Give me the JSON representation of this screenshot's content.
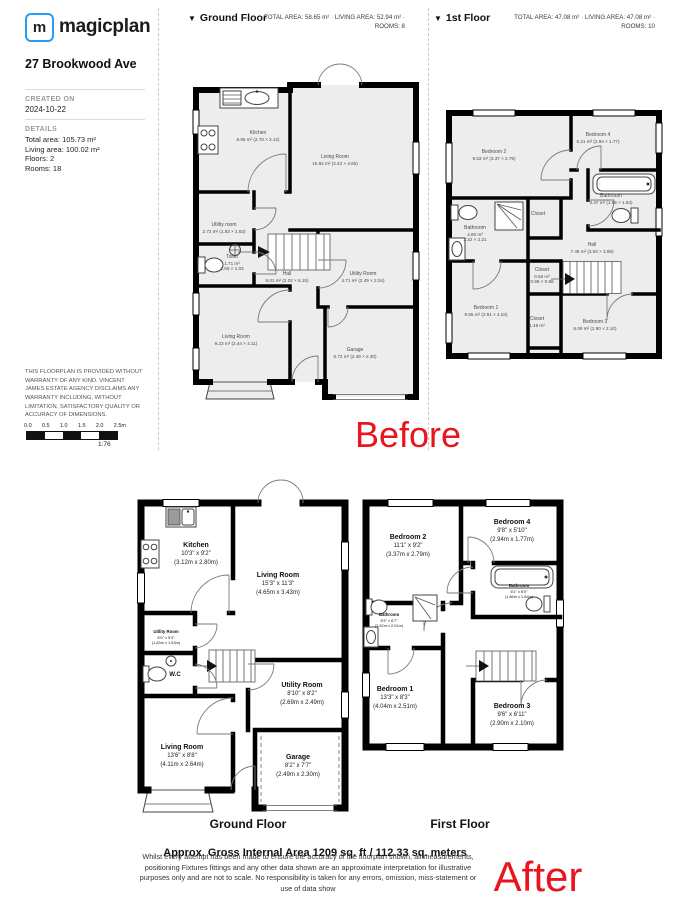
{
  "colors": {
    "accent_red": "#e8141e",
    "brand_blue": "#2b9cf3"
  },
  "sidebar": {
    "logo_letter": "m",
    "logo_text": "magicplan",
    "address": "27 Brookwood Ave",
    "created_label": "CREATED ON",
    "created_value": "2024-10-22",
    "details_label": "DETAILS",
    "details": [
      "Total area: 105.73 m²",
      "Living area: 100.02 m²",
      "Floors: 2",
      "Rooms: 18"
    ],
    "disclaimer": "THIS FLOORPLAN IS PROVIDED WITHOUT WARRANTY OF ANY KIND. VINCENT JAMES ESTATE AGENCY DISCLAIMS ANY WARRANTY INCLUDING, WITHOUT LIMITATION, SATISFACTORY QUALITY OR ACCURACY OF DIMENSIONS.",
    "scale_ticks": [
      "0.0",
      "0.5",
      "1.0",
      "1.5",
      "2.0",
      "2.5m"
    ],
    "scale_ratio": "1:76"
  },
  "headers": {
    "ground": {
      "title": "Ground Floor",
      "stats": "TOTAL AREA: 58.65 m² · LIVING AREA: 52.94 m² · ROOMS: 8"
    },
    "first": {
      "title": "1st Floor",
      "stats": "TOTAL AREA: 47.08 m² · LIVING AREA: 47.08 m² · ROOMS: 10"
    }
  },
  "before": {
    "caption": "Before",
    "ground_rooms": {
      "kitchen": {
        "name": "Kitchen",
        "l1": "8.66 m² (2.78 × 3.12)"
      },
      "living": {
        "name": "Living Room",
        "l1": "15.92 m² (3.43 × 4.65)"
      },
      "utility": {
        "name": "Utility room",
        "l1": "2.72 m² (1.83 × 1.63)"
      },
      "toilet": {
        "name": "Toilet",
        "l1": "1.71 m²",
        "l2": "1.66 × 1.03"
      },
      "hall": {
        "name": "Hall",
        "l1": "8.01 m² (2.02 × 6.15)"
      },
      "utility2": {
        "name": "Utility Room",
        "l1": "4.71 m² (2.49 × 2.04)"
      },
      "living2": {
        "name": "Living Room",
        "l1": "9.23 m² (2.44 × 4.11)"
      },
      "garage": {
        "name": "Garage",
        "l1": "5.72 m² (2.49 × 2.30)"
      }
    },
    "first_rooms": {
      "bed2": {
        "name": "Bedroom 2",
        "l1": "9.53 m² (3.37 × 2.79)"
      },
      "bed4": {
        "name": "Bedroom 4",
        "l1": "5.21 m² (2.94 × 1.77)"
      },
      "bath_r": {
        "name": "Bathroom",
        "l1": "3.47 m² (1.86 × 1.84)"
      },
      "closet_a": {
        "name": "Closet"
      },
      "bath_l": {
        "name": "Bathroom",
        "l1": "4.60 m²",
        "l2": "2.32 × 2.21"
      },
      "hall": {
        "name": "Hall",
        "l1": "7.49 m² (3.04 × 3.89)"
      },
      "closet_b": {
        "name": "Closet",
        "l1": "0.66 m²",
        "l2": "0.98 × 0.68"
      },
      "bed1": {
        "name": "Bedroom 1",
        "l1": "8.65 m² (2.51 × 4.04)"
      },
      "closet_c": {
        "name": "Closet",
        "l1": "1.48 m²"
      },
      "bed3": {
        "name": "Bedroom 3",
        "l1": "6.09 m² (2.90 × 2.10)"
      }
    }
  },
  "after": {
    "caption": "After",
    "ground_caption": "Ground Floor",
    "first_caption": "First Floor",
    "ground_rooms": {
      "kitchen": {
        "name": "Kitchen",
        "l1": "10'3\" x 9'2\"",
        "l2": "(3.12m x 2.80m)"
      },
      "living": {
        "name": "Living Room",
        "l1": "15'3\" x 11'3\"",
        "l2": "(4.65m x 3.43m)"
      },
      "utility": {
        "name": "Utility Room",
        "l1": "6'0\" x 5'4\"",
        "l2": "(1.83m x 1.63m)"
      },
      "wc": {
        "name": "W.C"
      },
      "utility2": {
        "name": "Utility Room",
        "l1": "8'10\" x 8'2\"",
        "l2": "(2.69m x 2.49m)"
      },
      "living2": {
        "name": "Living Room",
        "l1": "13'6\" x 8'8\"",
        "l2": "(4.11m x 2.64m)"
      },
      "garage": {
        "name": "Garage",
        "l1": "8'2\" x 7'7\"",
        "l2": "(2.49m x 2.30m)"
      }
    },
    "first_rooms": {
      "bed2": {
        "name": "Bedroom 2",
        "l1": "11'1\" x 9'2\"",
        "l2": "(3.37m x 2.79m)"
      },
      "bed4": {
        "name": "Bedroom 4",
        "l1": "9'8\" x 5'10\"",
        "l2": "(2.94m x 1.77m)"
      },
      "bath_l": {
        "name": "Bathroom",
        "l1": "8'3\" x 6'7\"",
        "l2": "(2.52m x 2.01m)"
      },
      "bath_r": {
        "name": "Bathroom",
        "l1": "6'1\" x 6'0\"",
        "l2": "(1.86m x 1.84m)"
      },
      "bed1": {
        "name": "Bedroom 1",
        "l1": "13'3\" x 8'3\"",
        "l2": "(4.04m x 2.51m)"
      },
      "bed3": {
        "name": "Bedroom 3",
        "l1": "9'6\" x 6'11\"",
        "l2": "(2.90m x 2.10m)"
      }
    },
    "area_title": "Approx. Gross Internal Area 1209 sq. ft / 112.33 sq. meters",
    "disclaimer": "Whilst every attempt has been made to ensure the accuracy of the floorplan shown, all measurements, positioning Fixtures fittings and any other data shown are an approximate interpretation for illustrative purposes only and are not to scale. No responsibility is taken for any errors, omission, miss-statement or use of data show"
  }
}
